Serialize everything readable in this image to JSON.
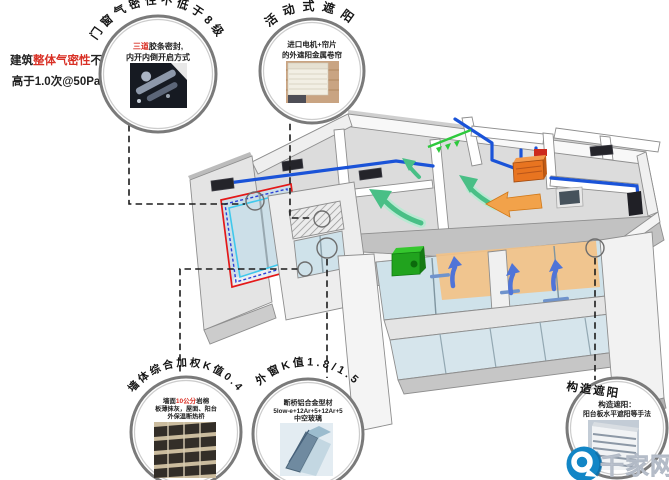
{
  "side_note": {
    "prefix": "建筑",
    "highlight": "整体气密性",
    "suffix": "不",
    "line2": "高于1.0次@50Pa"
  },
  "callouts": {
    "airtightness": {
      "title": "门窗气密性不低于8级",
      "body_red": "三道",
      "body_rest": "胶条密封,",
      "body_line2": "内开内倒开启方式"
    },
    "movable_shading": {
      "title": "活动式遮阳",
      "body_line1": "进口电机+帘片",
      "body_line2": "的外遮阳金属卷帘"
    },
    "wall_k": {
      "title": "墙体综合加权K值0.4",
      "line1_prefix": "墙面",
      "line1_red": "10公分",
      "line1_suffix": "岩棉",
      "body_line2": "板薄抹灰，屋面、阳台",
      "body_line3": "外保温断热桥"
    },
    "window_k": {
      "title": "外窗K值1.8/1.5",
      "body_line1": "断桥铝合金型材",
      "body_line2": "5low-e+12Ar+5+12Ar+5",
      "body_line3": "中空玻璃"
    },
    "structural_shading": {
      "title": "构造遮阳",
      "body_line1": "构造遮阳：",
      "body_line2": "阳台板水平遮阳等手法"
    }
  },
  "watermark": {
    "text": "千家网"
  },
  "colors": {
    "duct_blue": "#1a53d8",
    "fresh_air_green": "#49bf86",
    "warm_orange": "#f0a24a",
    "window_highlight_red": "#e41818",
    "window_highlight_blue": "#2b3fd8",
    "window_highlight_cyan": "#3fc8ec",
    "accent_red_text": "#d93025",
    "logo_blue": "#1286c6"
  }
}
